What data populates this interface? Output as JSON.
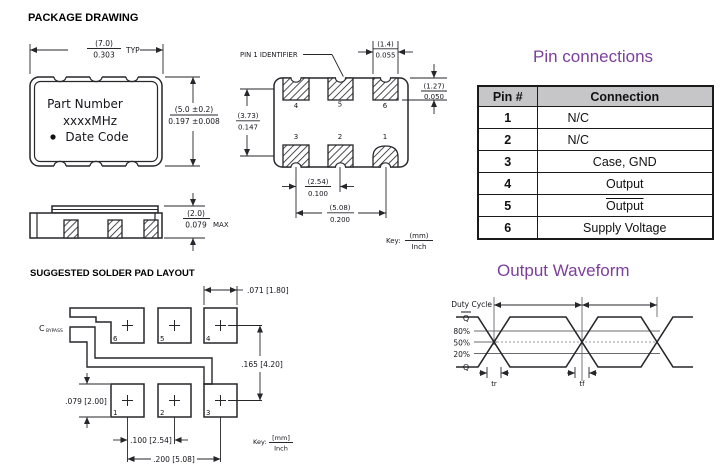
{
  "titles": {
    "package_drawing": "PACKAGE DRAWING",
    "solder_layout": "SUGGESTED SOLDER PAD LAYOUT",
    "pin_connections": "Pin connections",
    "output_waveform": "Output Waveform"
  },
  "package_front": {
    "label_line1": "Part Number",
    "label_line2": "xxxxMHz",
    "label_line3": "Date Code",
    "width_mm": "(7.0)",
    "width_in": "0.303",
    "width_suffix": "TYP",
    "height_mm": "(5.0 ±0.2)",
    "height_in": "0.197 ±0.008"
  },
  "side_view": {
    "height_mm": "(2.0)",
    "height_in": "0.079",
    "suffix": "MAX"
  },
  "pad_view": {
    "pin1_label": "PIN 1 IDENTIFIER",
    "pad_numbers_top": [
      "4",
      "5",
      "6"
    ],
    "pad_numbers_bottom": [
      "3",
      "2",
      "1"
    ],
    "pad_width_mm": "(1.4)",
    "pad_width_in": "0.055",
    "pad_height_mm": "(1.27)",
    "pad_height_in": "0.050",
    "row_spacing_mm": "(3.73)",
    "row_spacing_in": "0.147",
    "pitch_mm": "(2.54)",
    "pitch_in": "0.100",
    "span_mm": "(5.08)",
    "span_in": "0.200",
    "key_label": "Key:",
    "key_numerator": "(mm)",
    "key_denominator": "Inch"
  },
  "pin_table": {
    "headers": [
      "Pin #",
      "Connection"
    ],
    "rows": [
      {
        "pin": "1",
        "connection": "N/C"
      },
      {
        "pin": "2",
        "connection": "N/C"
      },
      {
        "pin": "3",
        "connection": "Case, GND"
      },
      {
        "pin": "4",
        "connection": "Output"
      },
      {
        "pin": "5",
        "connection": "Output"
      },
      {
        "pin": "6",
        "connection": "Supply Voltage"
      }
    ]
  },
  "solder_layout": {
    "cap_label_main": "C",
    "cap_label_sub": "BYPASS",
    "pad_numbers_top": [
      "6",
      "5",
      "4"
    ],
    "pad_numbers_bottom": [
      "1",
      "2",
      "3"
    ],
    "pad_width": ".071 [1.80]",
    "row_spacing": ".165 [4.20]",
    "pad_height": ".079 [2.00]",
    "pitch": ".100 [2.54]",
    "span": ".200 [5.08]",
    "key_label": "Key:",
    "key_numerator": "[mm]",
    "key_denominator": "Inch"
  },
  "waveform": {
    "duty_cycle": "Duty Cycle",
    "q_bar": "Q",
    "p80": "80%",
    "p50": "50%",
    "p20": "20%",
    "q": "Q",
    "tr": "tr",
    "tf": "tf"
  },
  "colors": {
    "accent": "#7c3f9c",
    "table_header_bg": "#c6c6c8",
    "line": "#26262b"
  }
}
